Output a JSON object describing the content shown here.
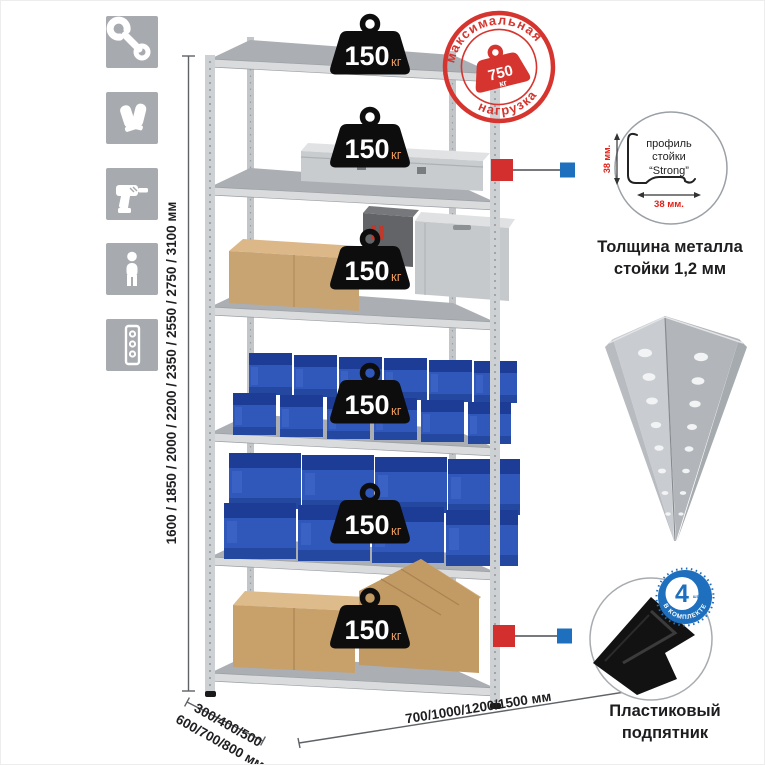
{
  "icon_strip": {
    "tile_color": "#a7aaae",
    "items": [
      {
        "name": "wrench-icon"
      },
      {
        "name": "gloves-icon"
      },
      {
        "name": "drill-icon"
      },
      {
        "name": "person-icon"
      },
      {
        "name": "upright-post-icon"
      }
    ]
  },
  "dimensions": {
    "height": "1600 / 1850 / 2000 / 2200 / 2350 / 2550 / 2750 / 3100 мм",
    "depth_line1": "300/400/500",
    "depth_line2": "600/700/800 мм",
    "width": "700/1000/1200/1500 мм"
  },
  "shelf_load": {
    "value": "150",
    "unit": "кг",
    "shelf_count": 6
  },
  "max_load_stamp": {
    "arc_top": "максимальная",
    "arc_bottom": "нагрузка",
    "value": "750",
    "unit": "кг"
  },
  "profile_callout": {
    "text_line1": "профиль",
    "text_line2": "стойки",
    "text_line3": "“Strong”",
    "dim_v": "38 мм.",
    "dim_h": "38 мм.",
    "caption_line1": "Толщина металла",
    "caption_line2": "стойки 1,2 мм"
  },
  "foot_callout": {
    "badge_value": "4",
    "badge_side_text": "штуки",
    "badge_arc": "в комплекте",
    "caption_line1": "Пластиковый",
    "caption_line2": "подпятник"
  },
  "colors": {
    "stamp_red": "#d6352f",
    "marker_red": "#d32f2f",
    "marker_blue": "#1e6fbe",
    "badge_blue": "#1e6fbe",
    "dim_red": "#e2231a",
    "weight_unit_color": "#e89a5f",
    "bin_blue": "#2f58ba",
    "shelf_gray": "#d9dbdd"
  }
}
